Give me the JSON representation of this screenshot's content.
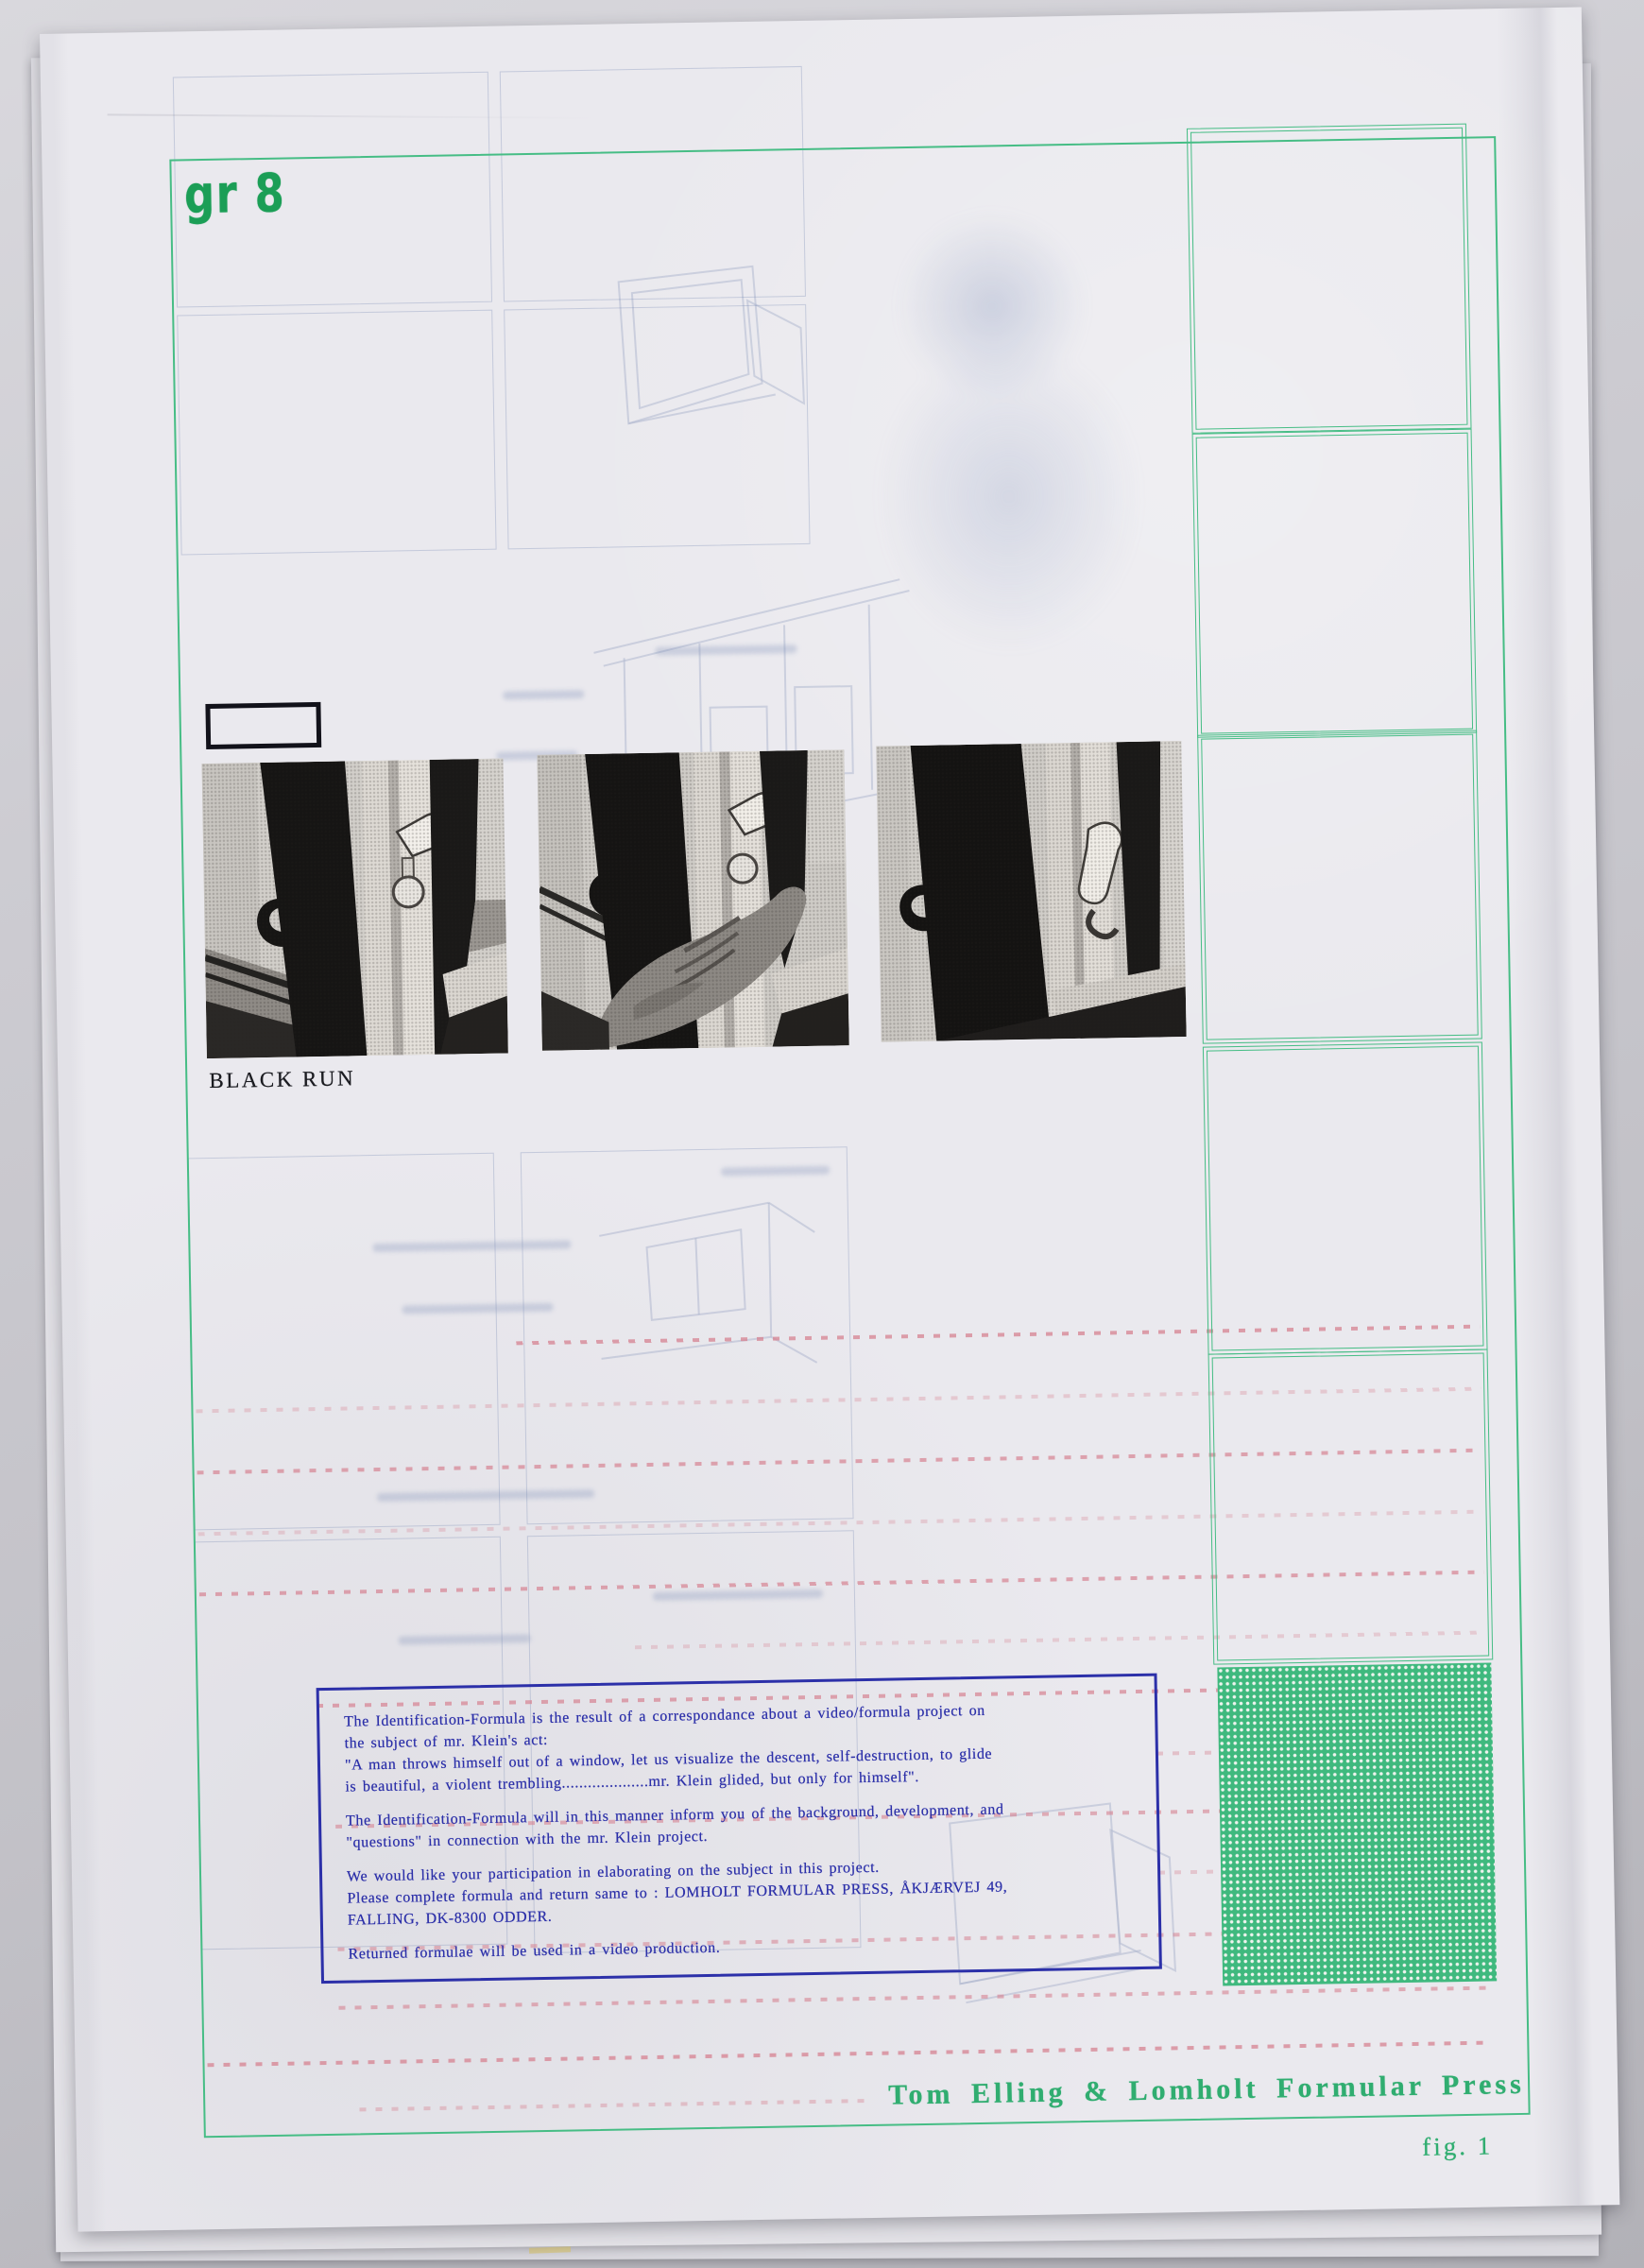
{
  "document": {
    "corner_mark": "gr 8",
    "credit_line": "Tom Elling & Lomholt Formular Press",
    "figure_label": "fig. 1"
  },
  "photos": {
    "caption": "BLACK RUN",
    "items": [
      {
        "name": "window-handle-photo-1"
      },
      {
        "name": "hand-on-window-handle-photo"
      },
      {
        "name": "window-handle-photo-2"
      }
    ]
  },
  "info_box": {
    "lines": [
      "The Identification-Formula is the result of a correspondance about a video/formula project on",
      "the subject of mr. Klein's act:",
      "\"A man throws himself out of a window, let us visualize the descent, self-destruction, to glide",
      "is beautiful, a violent trembling....................mr. Klein glided, but only for himself\".",
      "",
      "The Identification-Formula will in this manner inform you of the background, development, and",
      "\"questions\" in connection with the mr. Klein project.",
      "",
      "We would like your participation in elaborating on the subject in this project.",
      "Please complete formula and return same to :  LOMHOLT FORMULAR PRESS, ÅKJÆRVEJ 49,",
      "FALLING, DK-8300 ODDER.",
      "",
      "Returned formulae will be used in a video production."
    ]
  },
  "colors": {
    "frame_green": "#46bd85",
    "mark_green": "#1b9e56",
    "credit_green": "#30ad70",
    "halftone_green": "#3fb97e",
    "info_blue": "#2c30a9",
    "dotted_pink": "#d68291"
  }
}
